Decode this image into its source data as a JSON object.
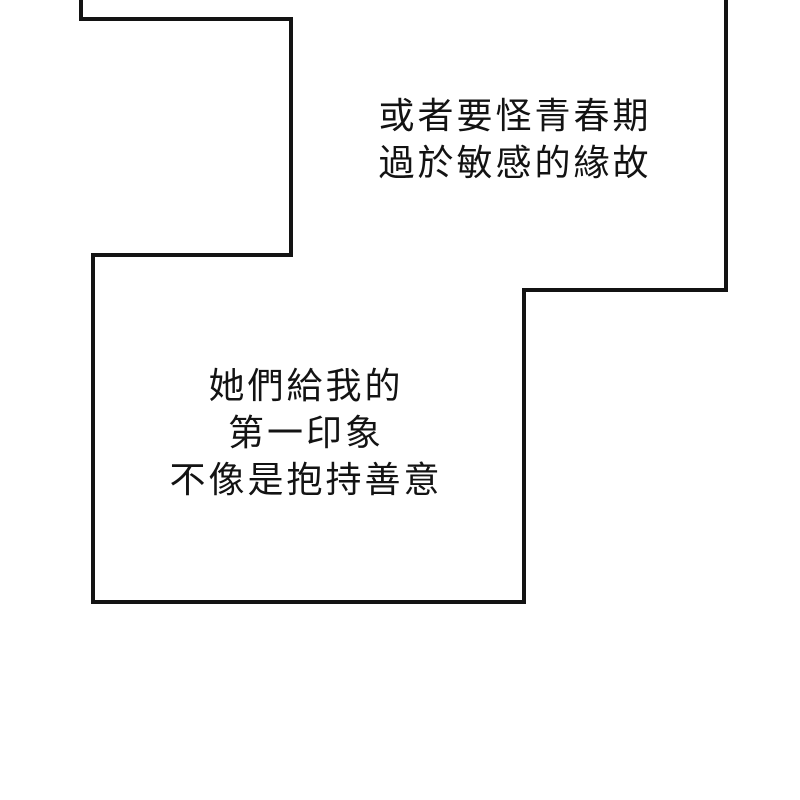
{
  "page": {
    "background_color": "#ffffff",
    "ink_color": "#131313",
    "type": "webtoon-comic-page"
  },
  "panel": {
    "outline_points": "81,-6 81,19 291,19 291,255 93,255 93,602 524,602 524,290 726,290 726,-6",
    "fill_color": "#ffffff",
    "stroke_color": "#131313",
    "stroke_width": "4"
  },
  "narration": {
    "top": {
      "lines": [
        "或者要怪青春期",
        "過於敏感的緣故"
      ]
    },
    "bottom": {
      "lines": [
        "她們給我的",
        "第一印象",
        "不像是抱持善意"
      ]
    }
  }
}
